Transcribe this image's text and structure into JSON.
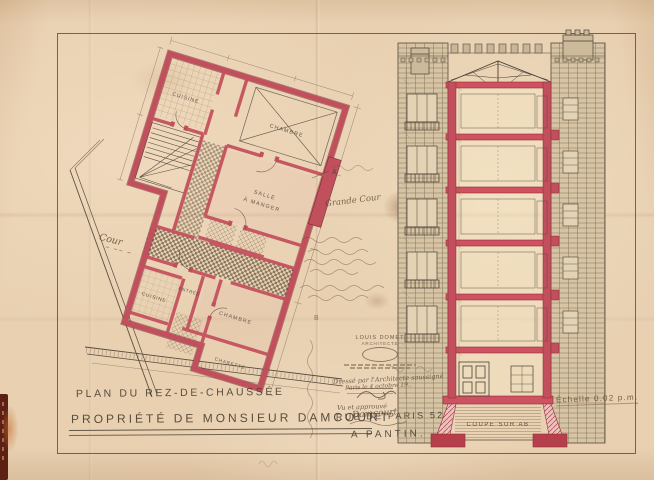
{
  "titles": {
    "plan": "PLAN DU REZ-DE-CHAUSSÉE",
    "property": "PROPRIÉTÉ DE MONSIEUR DAMCOURT",
    "street": "RUE DE PARIS 52",
    "city": "A PANTIN."
  },
  "section_view": {
    "caption": "COUPE SUR AB",
    "scale_note": "Échelle 0.02 p.m."
  },
  "plan_view": {
    "rooms": {
      "cuisine_top": "CUISINE",
      "chambre_top": "CHAMBRE",
      "salle_line1": "SALLE",
      "salle_line2": "À MANGER",
      "chambre_mid": "CHAMBRE",
      "entree": "ENTRÉE",
      "cuisine_low": "CUISINE",
      "charette": "CHARETTE"
    },
    "court": "Cour",
    "grande_cour": "Grande Cour",
    "marker_a": "A",
    "marker_b": "B"
  },
  "stamp": {
    "name": "LOUIS DOMET",
    "title": "ARCHITECTE"
  },
  "notes": {
    "drafted": "Dressé par l'Architecte soussigné",
    "dated": "Paris le 4 octobre 19..",
    "approved": "Vu et approuvé",
    "signature": "Damcourt"
  },
  "colors": {
    "wall_red": "#c14f5c",
    "slab_red": "#cf5260",
    "paper": "#e8d0b1",
    "ink": "#4a4136"
  }
}
